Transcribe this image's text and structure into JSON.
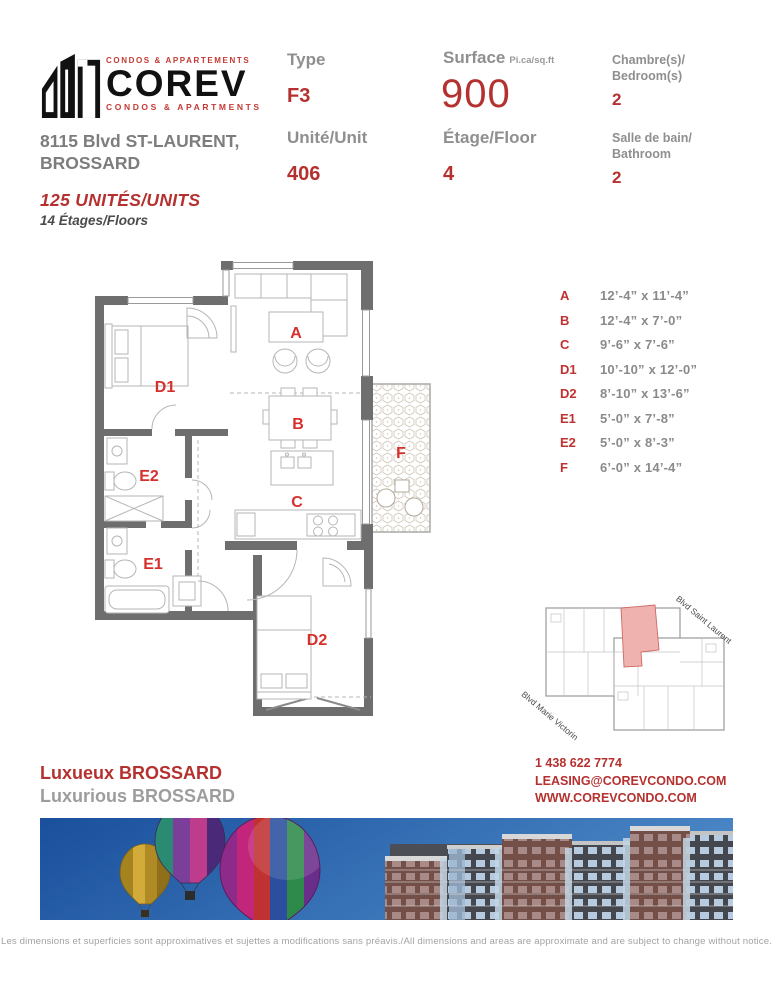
{
  "brand": {
    "tagline_top": "CONDOS & APPARTEMENTS",
    "name": "COREV",
    "tagline_bottom": "CONDOS & APARTMENTS",
    "address_line1": "8115 Blvd ST-LAURENT,",
    "address_line2": "BROSSARD",
    "units_line": "125 UNITÉS/UNITS",
    "floors_line": "14 Étages/Floors"
  },
  "specs": {
    "type": {
      "label": "Type",
      "value": "F3"
    },
    "unit": {
      "label": "Unité/Unit",
      "value": "406"
    },
    "surface": {
      "label": "Surface",
      "suffix": "Pi.ca/sq.ft",
      "value": "900"
    },
    "floor": {
      "label": "Étage/Floor",
      "value": "4"
    },
    "bedrooms": {
      "label1": "Chambre(s)/",
      "label2": "Bedroom(s)",
      "value": "2"
    },
    "bathrooms": {
      "label1": "Salle de bain/",
      "label2": "Bathroom",
      "value": "2"
    }
  },
  "floor_plan": {
    "labels": {
      "A": "A",
      "B": "B",
      "C": "C",
      "D1": "D1",
      "D2": "D2",
      "E1": "E1",
      "E2": "E2",
      "F": "F"
    }
  },
  "dimensions": [
    {
      "room": "A",
      "size": "12’-4” x 11’-4”"
    },
    {
      "room": "B",
      "size": "12’-4” x 7’-0”"
    },
    {
      "room": "C",
      "size": "9’-6” x 7’-6”"
    },
    {
      "room": "D1",
      "size": "10’-10” x 12’-0”"
    },
    {
      "room": "D2",
      "size": "8’-10” x 13’-6”"
    },
    {
      "room": "E1",
      "size": "5’-0” x 7’-8”"
    },
    {
      "room": "E2",
      "size": "5’-0” x 8’-3”"
    },
    {
      "room": "F",
      "size": "6’-0” x 14’-4”"
    }
  ],
  "key_plan": {
    "street_top": "Blvd Saint Laurent",
    "street_bottom": "Blvd Marie Victorin"
  },
  "contact": {
    "headline_fr": "Luxueux BROSSARD",
    "headline_en": "Luxurious BROSSARD",
    "phone": "1 438 622 7774",
    "email": "LEASING@COREVCONDO.COM",
    "website": "WWW.COREVCONDO.COM"
  },
  "footer": {
    "disclaimer": "Les dimensions et superficies sont approximatives et sujettes a modifications sans préavis./All dimensions and areas are approximate and are subject to change without notice."
  },
  "colors": {
    "accent_red": "#b5312f",
    "room_label_red": "#d6302c",
    "label_gray": "#8f8f8f",
    "wall_gray": "#6e6e6e",
    "highlight_pink": "#efb2ae"
  }
}
